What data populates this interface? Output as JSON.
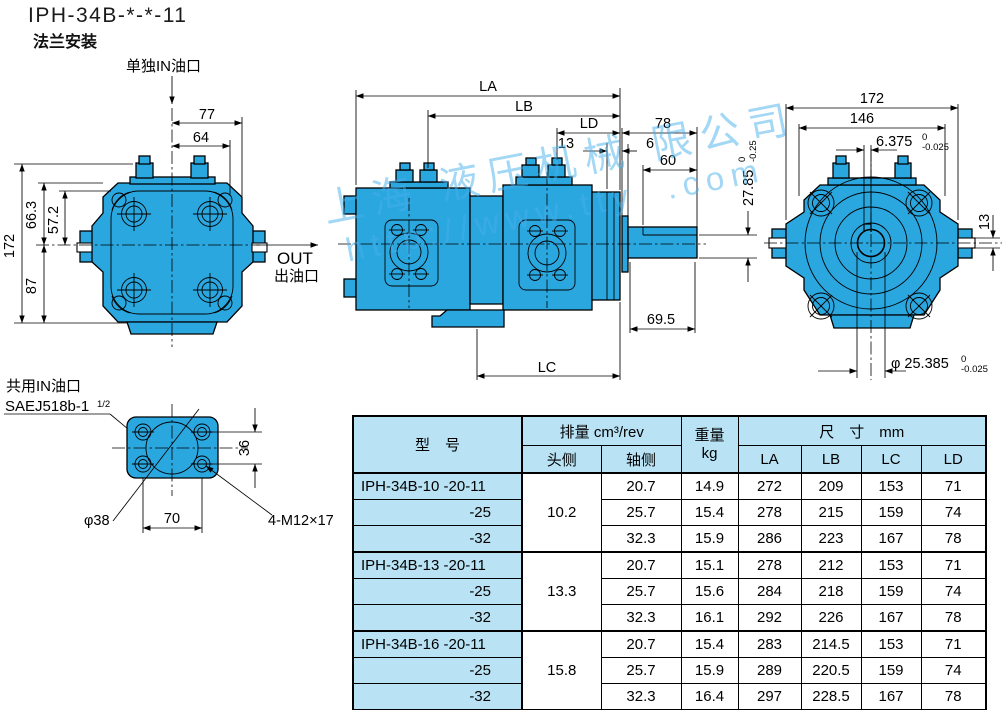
{
  "title": "IPH-34B-*-*-11",
  "subtitle": "法兰安装",
  "colors": {
    "pump_blue": "#2ba7e0",
    "table_blue": "#b9e3f5",
    "watermark_blue": "rgba(70,175,235,0.5)"
  },
  "watermark": {
    "line1": "上海 液压机械 限公司",
    "line2": "http://www.tty  .com"
  },
  "front": {
    "in_port": "单独IN油口",
    "out": "OUT",
    "out_port": "出油口",
    "d77": "77",
    "d64": "64",
    "d663": "66.3",
    "d572": "57.2",
    "d172": "172",
    "d87": "87"
  },
  "side": {
    "la": "LA",
    "lb": "LB",
    "ld": "LD",
    "d13": "13",
    "d6": "6",
    "d78": "78",
    "d60": "60",
    "d2785": "27.85",
    "d2785_tu": "0",
    "d2785_tl": "-0.25",
    "d695": "69.5",
    "lc": "LC"
  },
  "rear": {
    "d172": "172",
    "d146": "146",
    "key": "6.375",
    "key_tu": "0",
    "key_tl": "-0.025",
    "d13": "13",
    "shaft": "φ 25.385",
    "shaft_tu": "0",
    "shaft_tl": "-0.025"
  },
  "flange": {
    "port": "共用IN油口",
    "sae": "SAEJ518b-1",
    "sae_frac": "1/2",
    "d36": "36",
    "d70": "70",
    "d38": "φ38",
    "bolt": "4-M12×17"
  },
  "table": {
    "h_model": "型　号",
    "h_disp": "排量 cm³/rev",
    "h_head": "头侧",
    "h_shaft": "轴侧",
    "h_weight": "重量",
    "h_weight_unit": "kg",
    "h_size": "尺　寸　mm",
    "h_la": "LA",
    "h_lb": "LB",
    "h_lc": "LC",
    "h_ld": "LD",
    "rows": [
      {
        "model": "IPH-34B-10 -20-11",
        "head": "10.2",
        "shaft": "20.7",
        "weight": "14.9",
        "la": "272",
        "lb": "209",
        "lc": "153",
        "ld": "71"
      },
      {
        "model": "-25",
        "shaft": "25.7",
        "weight": "15.4",
        "la": "278",
        "lb": "215",
        "lc": "159",
        "ld": "74"
      },
      {
        "model": "-32",
        "shaft": "32.3",
        "weight": "15.9",
        "la": "286",
        "lb": "223",
        "lc": "167",
        "ld": "78"
      },
      {
        "model": "IPH-34B-13 -20-11",
        "head": "13.3",
        "shaft": "20.7",
        "weight": "15.1",
        "la": "278",
        "lb": "212",
        "lc": "153",
        "ld": "71"
      },
      {
        "model": "-25",
        "shaft": "25.7",
        "weight": "15.6",
        "la": "284",
        "lb": "218",
        "lc": "159",
        "ld": "74"
      },
      {
        "model": "-32",
        "shaft": "32.3",
        "weight": "16.1",
        "la": "292",
        "lb": "226",
        "lc": "167",
        "ld": "78"
      },
      {
        "model": "IPH-34B-16 -20-11",
        "head": "15.8",
        "shaft": "20.7",
        "weight": "15.4",
        "la": "283",
        "lb": "214.5",
        "lc": "153",
        "ld": "71"
      },
      {
        "model": "-25",
        "shaft": "25.7",
        "weight": "15.9",
        "la": "289",
        "lb": "220.5",
        "lc": "159",
        "ld": "74"
      },
      {
        "model": "-32",
        "shaft": "32.3",
        "weight": "16.4",
        "la": "297",
        "lb": "228.5",
        "lc": "167",
        "ld": "78"
      }
    ]
  }
}
